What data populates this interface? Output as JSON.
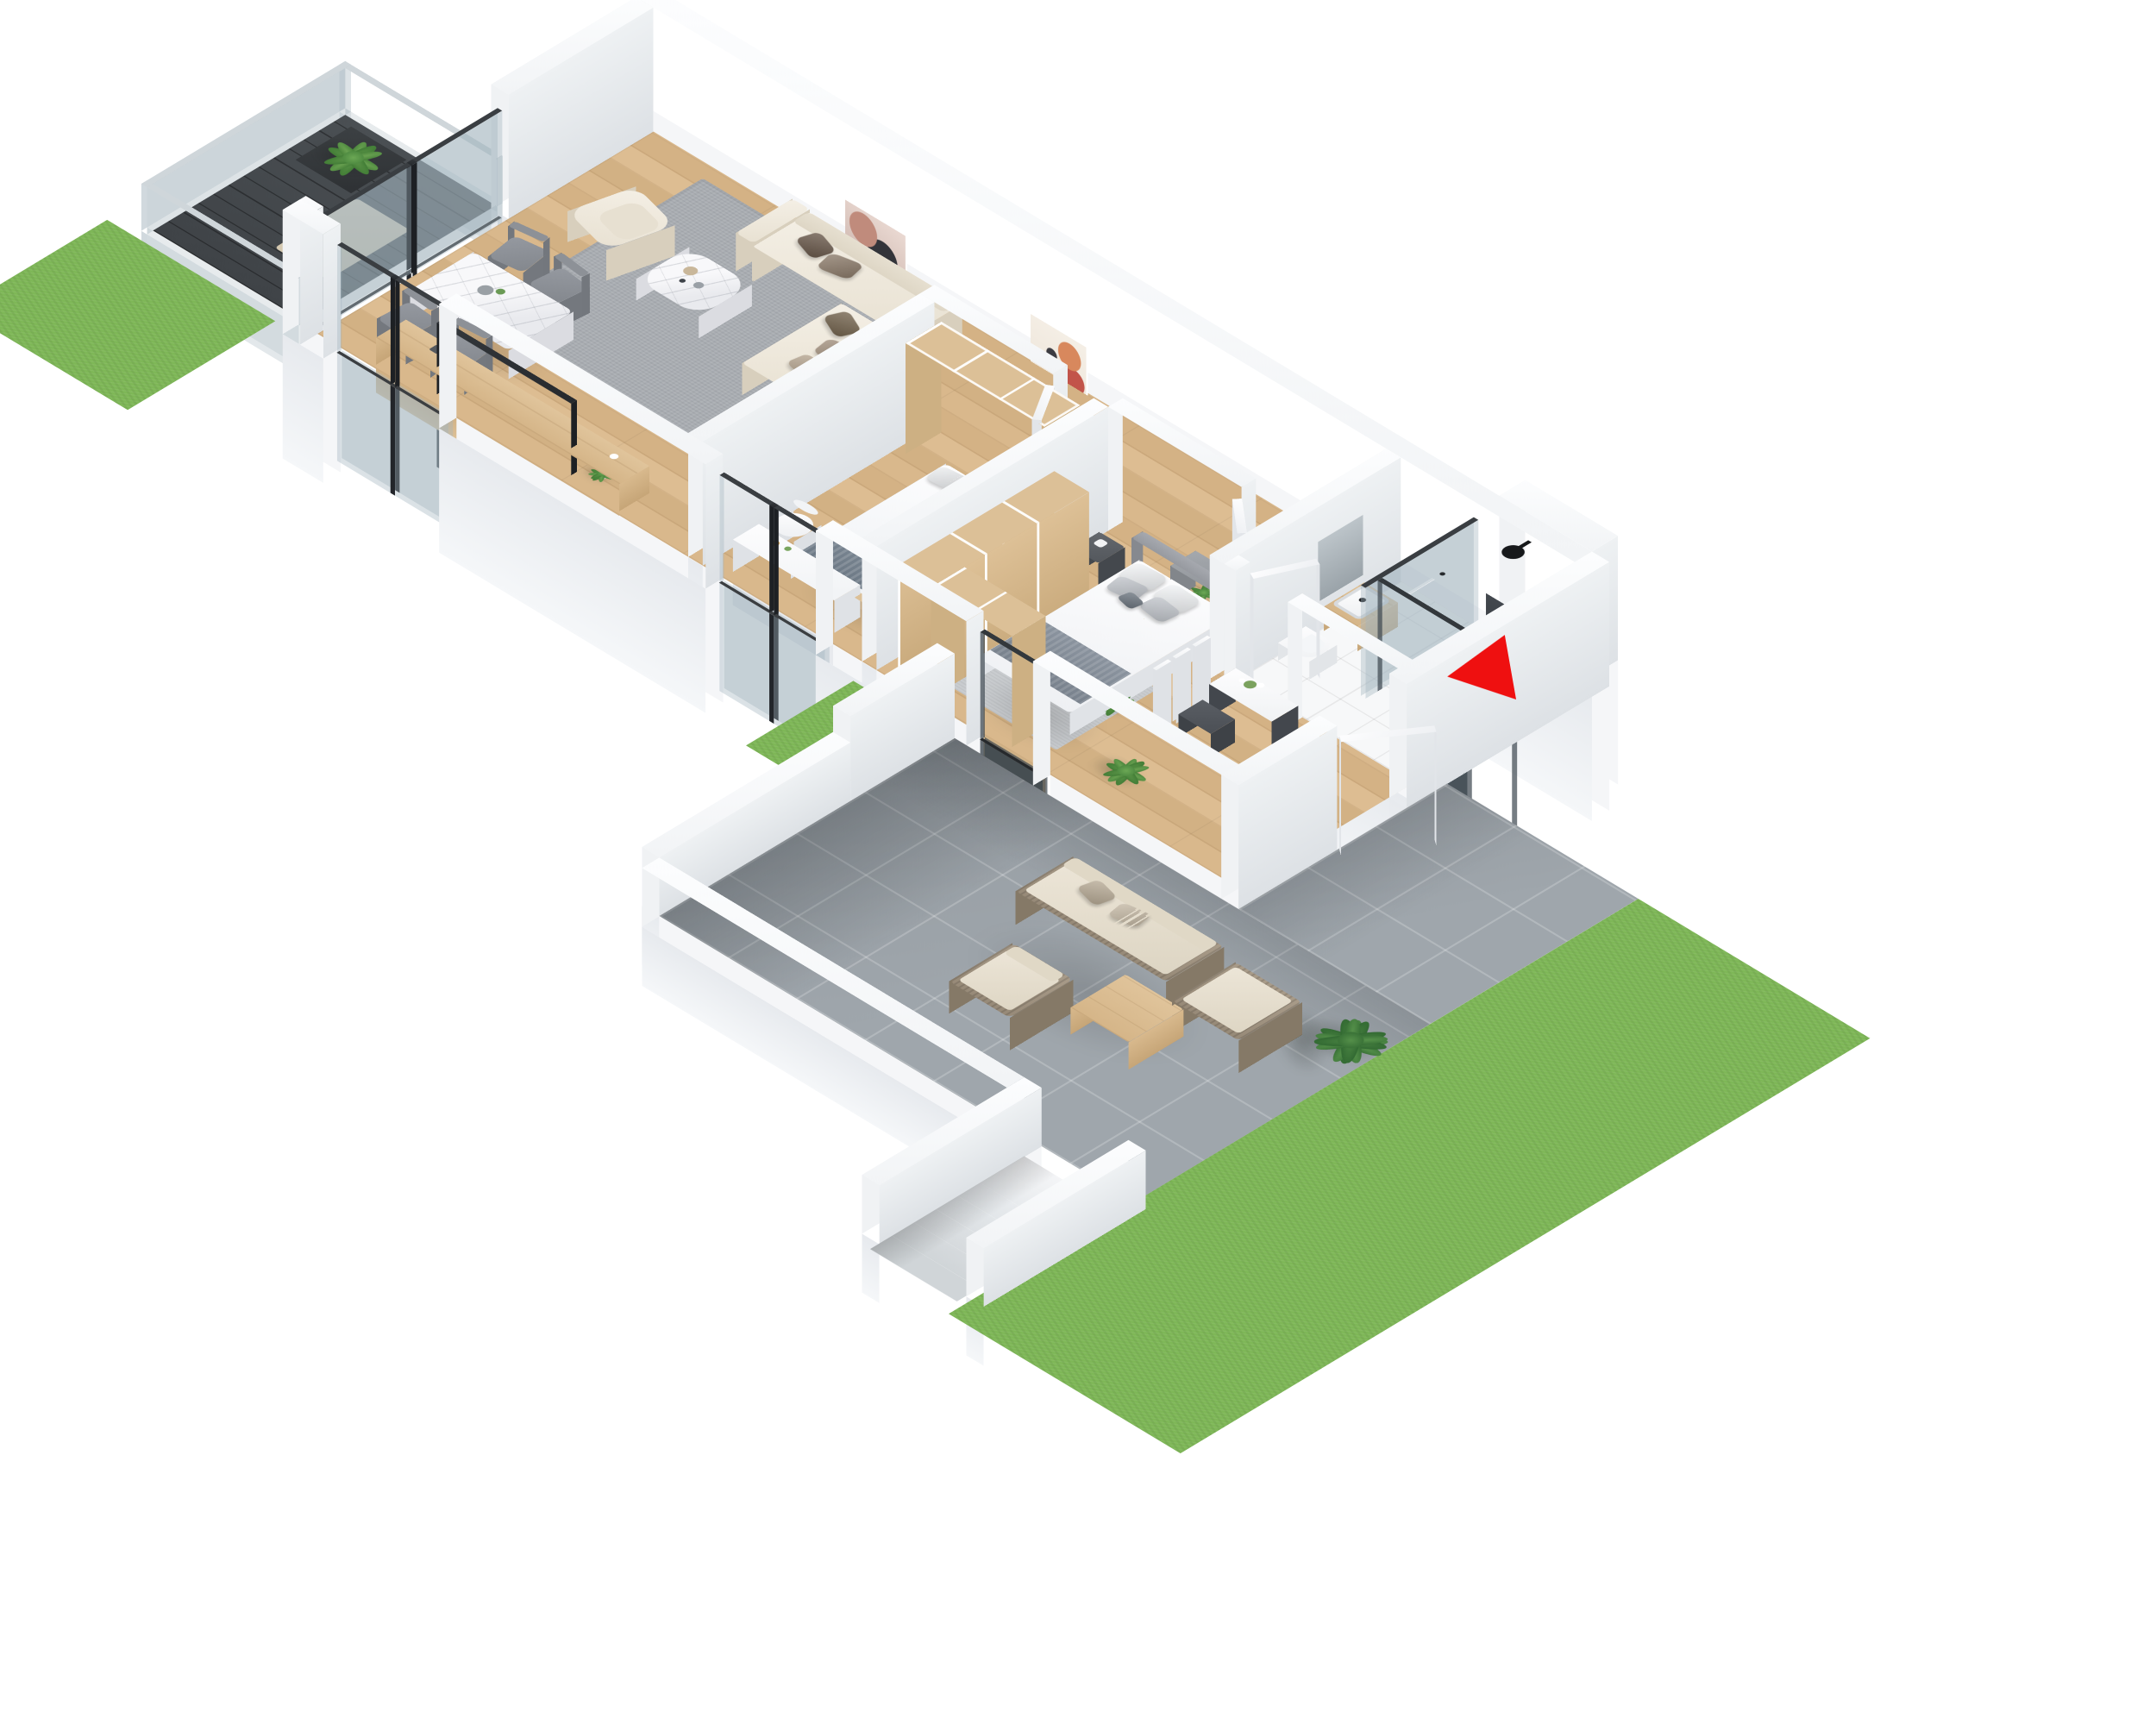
{
  "scene": {
    "type": "isometric-3d-floor-plan-render",
    "background_color": "#ffffff",
    "view": "top-down axonometric, apartment rotated 45 degrees, garden at lower right"
  },
  "entrance_marker": {
    "icon": "red-arrow",
    "color": "#ef1010",
    "points_to": "entrance-door"
  },
  "palette": {
    "wall": "#f2f4f6",
    "wall_top": "#fbfcfd",
    "wood_floor": "#d8b78b",
    "wood_furniture": "#dcc097",
    "bath_tile": "#f6f7f8",
    "paver": "#9fa6ac",
    "grass": "#7eb757",
    "balcony_deck": "#45494d",
    "rug_gray": "#a9adb2",
    "rug_light": "#c9cccf",
    "sofa_cream": "#efe9dd",
    "marble": "#f2f2f5",
    "charcoal": "#2f3337",
    "chair_gray": "#8f9397",
    "rattan": "#a09382",
    "outdoor_cushion": "#e9e2d4",
    "leaf_green": "#4e8f3d",
    "glass": "rgba(160,180,190,0.38)",
    "red": "#ef1010"
  },
  "rooms": [
    {
      "name": "living-room",
      "floor": "wood",
      "furniture": [
        "corner-sofa",
        "sofa-pillows",
        "armchair",
        "coffee-table",
        "area-rug",
        "tv-sideboard",
        "tv",
        "potted-plant",
        "wall-art-abstract",
        "window-sliding-door"
      ]
    },
    {
      "name": "dining-area",
      "floor": "wood",
      "furniture": [
        "marble-dining-table",
        "dining-chair",
        "dining-chair",
        "dining-chair",
        "dining-chair",
        "vase-decor",
        "balcony-sliding-door"
      ]
    },
    {
      "name": "corridor",
      "floor": "wood",
      "furniture": [
        "wall-art-abstract"
      ]
    },
    {
      "name": "bedroom-1",
      "floor": "wood",
      "furniture": [
        "single-bed",
        "pillows",
        "wardrobe-sliding-doors",
        "tall-cabinet",
        "desk",
        "desk-chair",
        "window"
      ]
    },
    {
      "name": "bedroom-2-master",
      "floor": "wood",
      "furniture": [
        "double-bed",
        "upholstered-headboard",
        "pillows",
        "nightstand",
        "dresser",
        "wardrobe-l-shaped",
        "area-rug",
        "potted-plant",
        "terrace-sliding-door",
        "room-door"
      ]
    },
    {
      "name": "bathroom",
      "floor": "white-tile",
      "furniture": [
        "walk-in-shower",
        "glass-partition",
        "tinted-glass-panel",
        "rain-shower-head",
        "hand-shower",
        "wall-niche",
        "mirror",
        "washbasin-on-wood-stand",
        "wall-hung-toilet",
        "bathroom-door",
        "tinted-window"
      ]
    },
    {
      "name": "entrance-hall",
      "floor": "wood",
      "furniture": [
        "entrance-door",
        "coat-rack-hangers",
        "console-cabinet",
        "flower-vase",
        "dark-stool",
        "potted-plant"
      ]
    },
    {
      "name": "balcony",
      "floor": "dark-decking",
      "furniture": [
        "glass-railing",
        "potted-plant",
        "outdoor-mat"
      ]
    },
    {
      "name": "terrace",
      "floor": "concrete-pavers",
      "furniture": [
        "rattan-outdoor-sofa",
        "outdoor-pillows",
        "rattan-ottoman",
        "rattan-armchair",
        "wooden-coffee-table",
        "potted-palm"
      ]
    },
    {
      "name": "garden",
      "floor": "lawn-grass",
      "furniture": [
        "exterior-staircase",
        "lawn",
        "side-lawn-patch"
      ]
    }
  ]
}
